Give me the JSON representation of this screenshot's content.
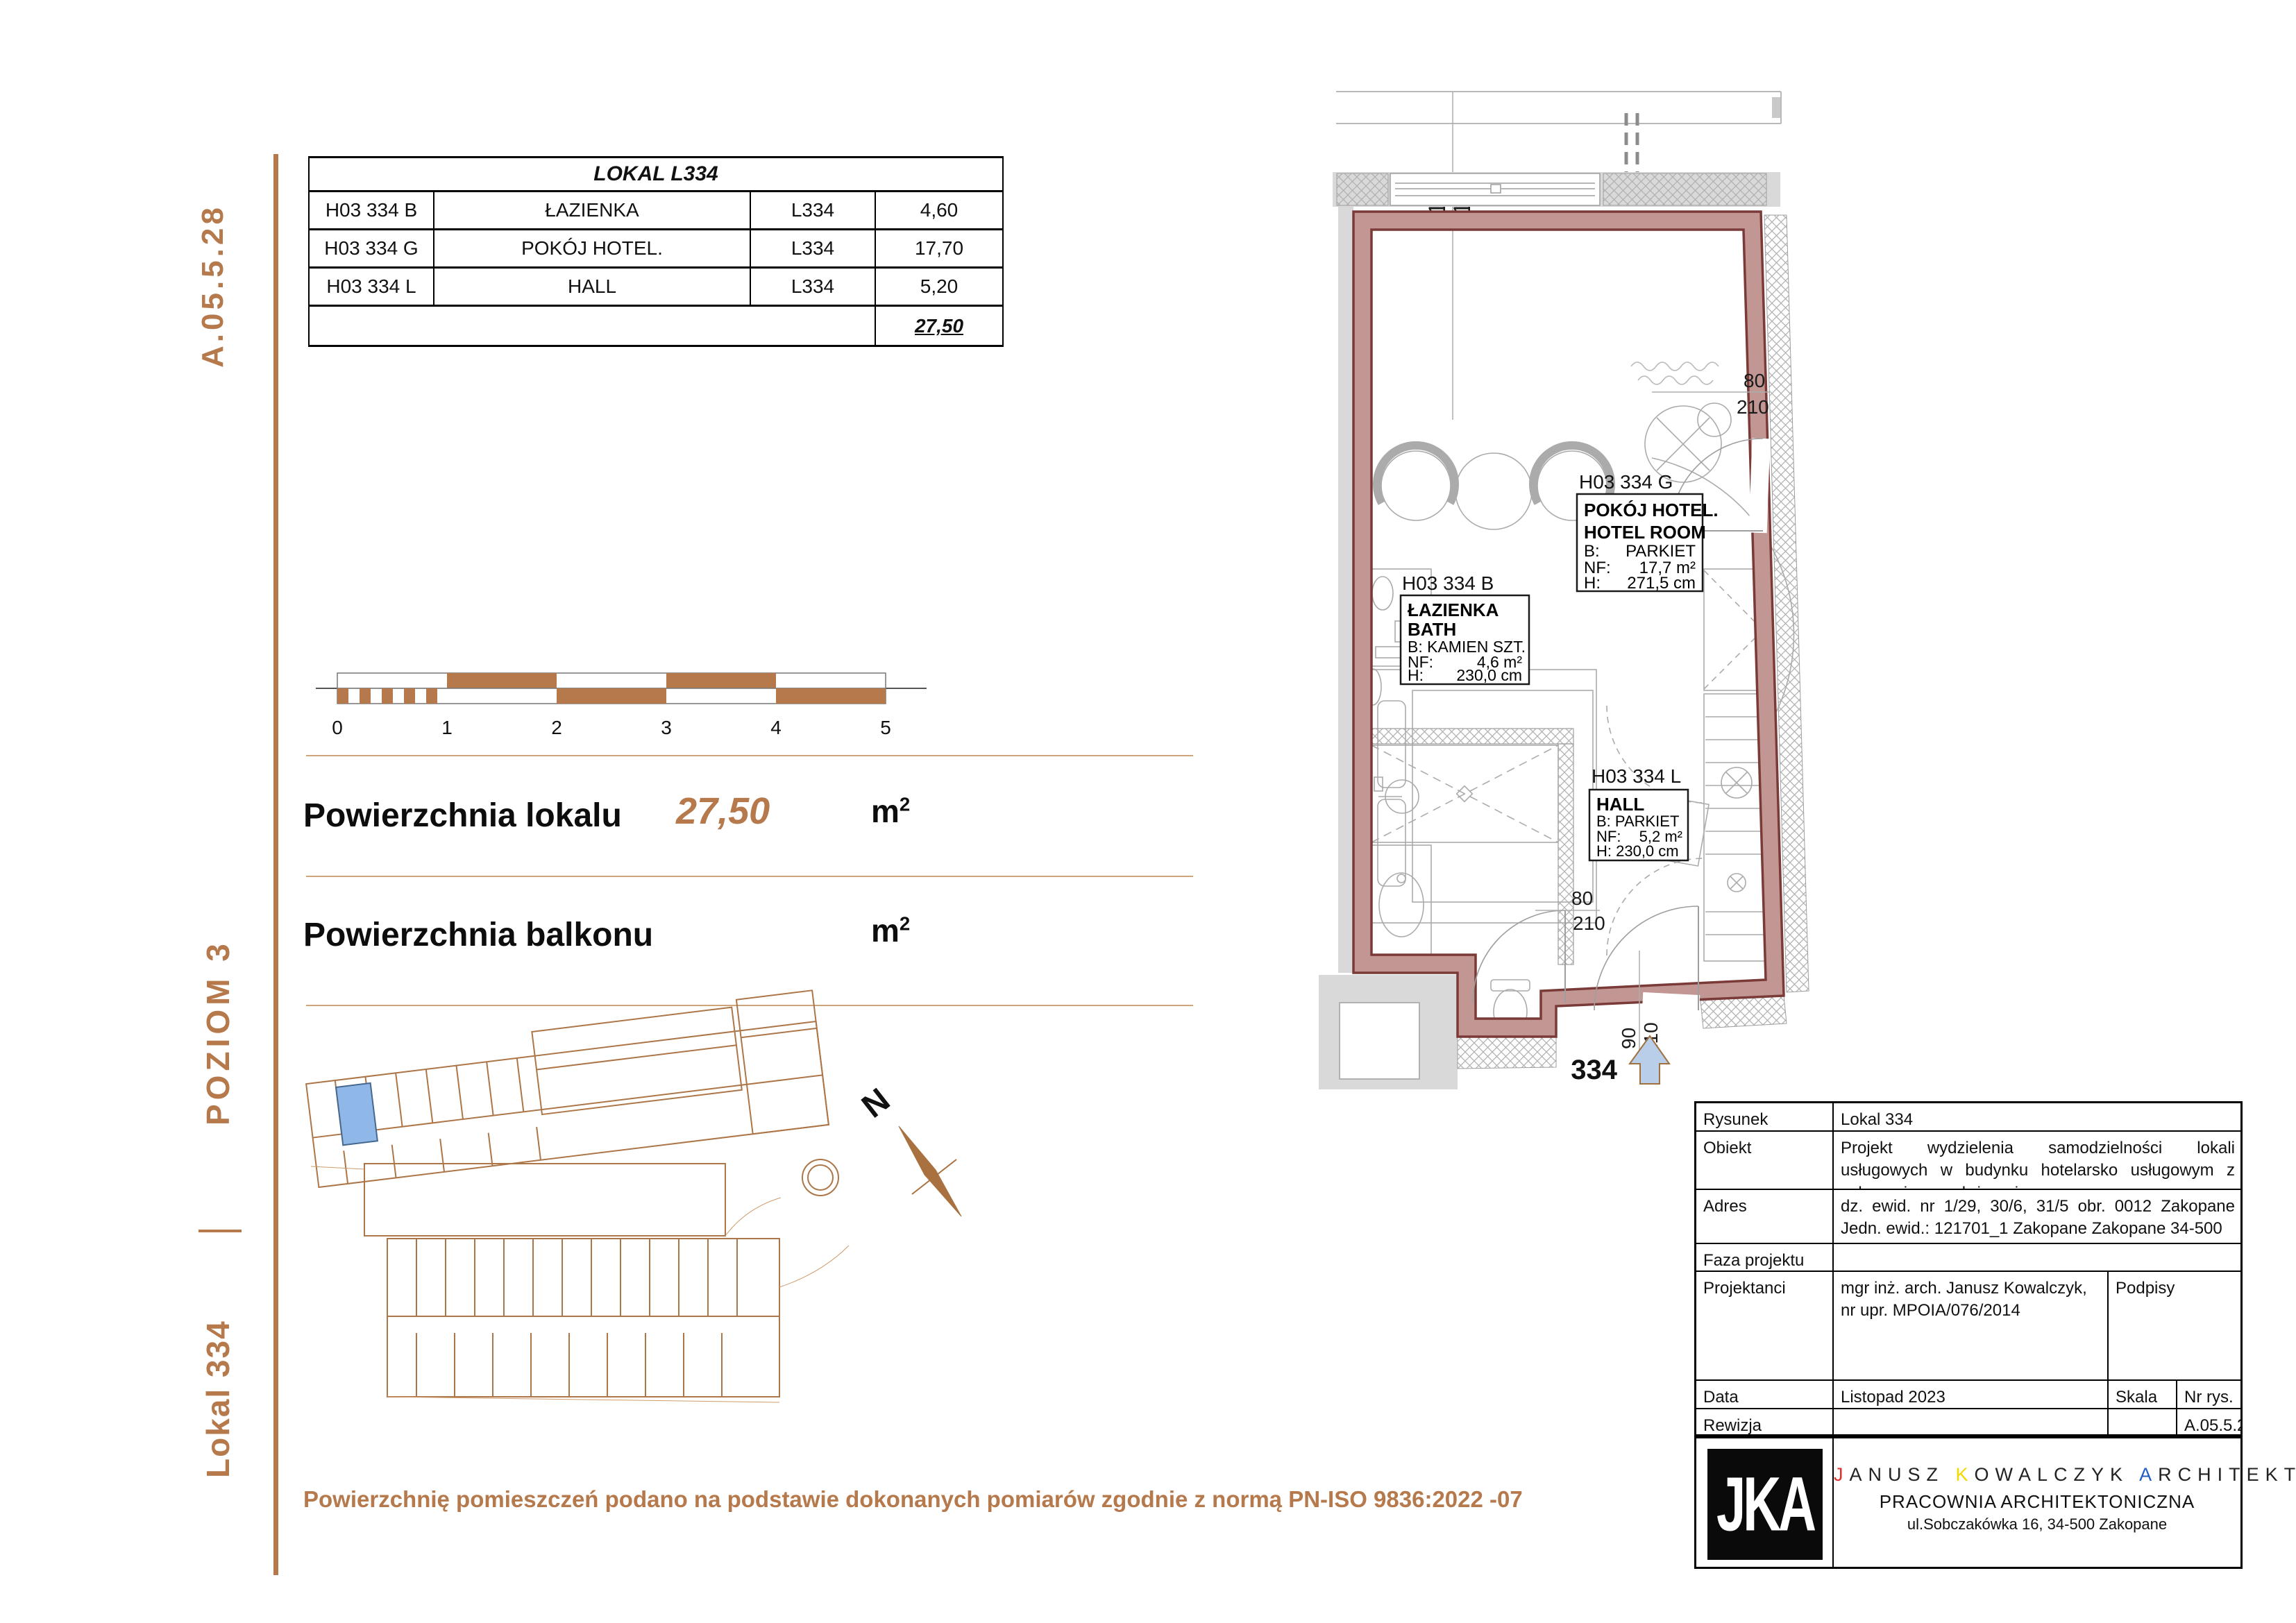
{
  "page": {
    "sheet_code": "A.05.5.28",
    "level": "POZIOM 3",
    "unit": "Lokal 334",
    "footnote": "Powierzchnię pomieszczeń podano na podstawie dokonanych pomiarów zgodnie z normą PN-ISO 9836:2022 -07"
  },
  "area_table": {
    "title": "LOKAL L334",
    "rows": [
      {
        "code": "H03 334 B",
        "room": "ŁAZIENKA",
        "unit": "L334",
        "area": "4,60"
      },
      {
        "code": "H03 334 G",
        "room": "POKÓJ HOTEL.",
        "unit": "L334",
        "area": "17,70"
      },
      {
        "code": "H03 334 L",
        "room": "HALL",
        "unit": "L334",
        "area": "5,20"
      }
    ],
    "total_area": "27,50"
  },
  "scale_bar": {
    "t0": "0",
    "t1": "1",
    "t2": "2",
    "t3": "3",
    "t4": "4",
    "t5": "5"
  },
  "summary": {
    "area_label": "Powierzchnia lokalu",
    "area_value": "27,50",
    "balcony_label": "Powierzchnia balkonu",
    "unit_m": "m",
    "unit_sup": "2"
  },
  "north": {
    "label": "N"
  },
  "plan": {
    "dims": {
      "w1": "182",
      "w2": "157",
      "door_right_w": "80",
      "door_right_h": "210",
      "door_hall_w": "80",
      "door_hall_h": "210",
      "entry_w": "90",
      "entry_h": "210",
      "entry_no": "334"
    },
    "room_hotel": {
      "caption": "H03 334 G",
      "name": "POKÓJ HOTEL.",
      "name_en": "HOTEL ROOM",
      "b_label": "B:",
      "b": "PARKIET",
      "nf_label": "NF:",
      "nf": "17,7 m²",
      "h_label": "H:",
      "h": "271,5 cm"
    },
    "room_bath": {
      "caption": "H03 334 B",
      "name": "ŁAZIENKA",
      "name_en": "BATH",
      "b": "B: KAMIEN SZT.",
      "nf_label": "NF:",
      "nf": "4,6 m²",
      "h_label": "H:",
      "h": "230,0 cm"
    },
    "room_hall": {
      "caption": "H03 334 L",
      "name": "HALL",
      "b": "B: PARKIET",
      "nf_label": "NF:",
      "nf": "5,2 m²",
      "h": "H: 230,0 cm"
    }
  },
  "title_block": {
    "rysunek_label": "Rysunek",
    "rysunek": "Lokal 334",
    "obiekt_label": "Obiekt",
    "obiekt": "Projekt wydzielenia samodzielności lokali usługowych w budynku hotelarsko usługowym z usługami przynależnymi.",
    "adres_label": "Adres",
    "adres": "dz. ewid. nr 1/29, 30/6, 31/5 obr. 0012 Zakopane Jedn. ewid.: 121701_1 Zakopane Zakopane 34-500",
    "faza_label": "Faza projektu",
    "projektanci_label": "Projektanci",
    "projektanci": "mgr inż. arch. Janusz Kowalczyk, nr upr. MPOIA/076/2014",
    "podpisy_label": "Podpisy",
    "data_label": "Data",
    "data": "Listopad 2023",
    "skala_label": "Skala",
    "nr_label": "Nr rys.",
    "rewizja_label": "Rewizja",
    "nr_value": "A.05.5.28",
    "logo": "JKA",
    "firm": {
      "p1": "J",
      "p2": "ANUSZ ",
      "p3": "K",
      "p4": "OWALCZYK ",
      "p5": "A",
      "p6": "RCHITEKT",
      "line2": "PRACOWNIA ARCHITEKTONICZNA",
      "line3": "ul.Sobczakówka 16, 34-500 Zakopane"
    }
  },
  "colors": {
    "accent_brown": "#b5794c",
    "wall_fill": "#c29793",
    "wall_edge": "#7a3a37",
    "highlight_blue": "#8fb8e8",
    "arrow_blue": "#b9cfe9"
  }
}
